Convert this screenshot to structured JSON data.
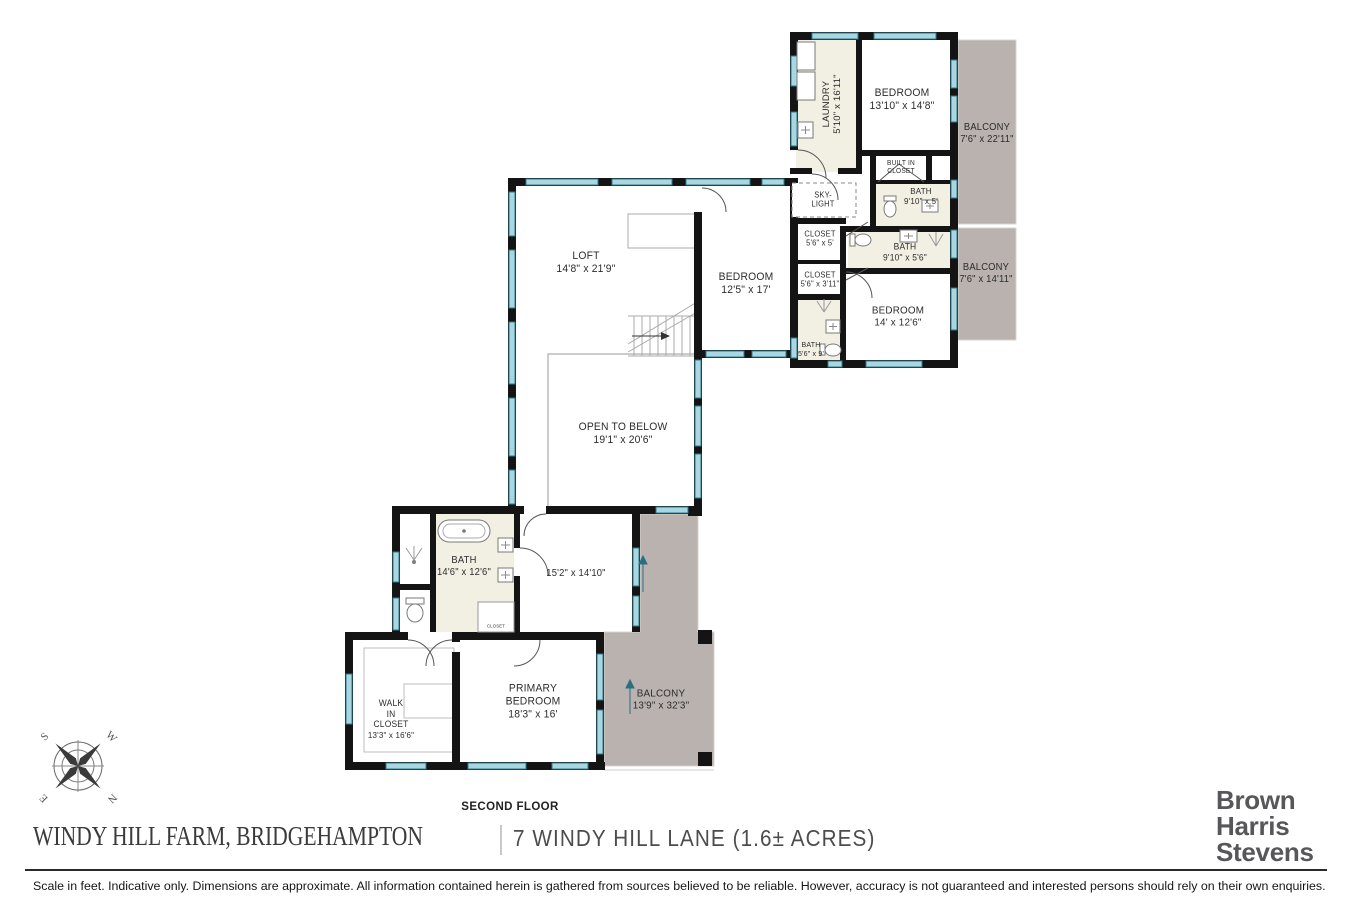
{
  "colors": {
    "wall": "#141414",
    "window_fill": "#a9d6e0",
    "window_border": "#2e7a8b",
    "balcony_fill": "#b9b2ae",
    "bath_floor": "#f2efe3",
    "thin_line": "#bcbcbc",
    "brand_gray": "#57575a"
  },
  "rooms": {
    "laundry": {
      "name": "LAUNDRY",
      "dims": "5'10\" x 16'11\""
    },
    "bedroom_top": {
      "name": "BEDROOM",
      "dims": "13'10\" x 14'8\""
    },
    "balcony_top": {
      "name": "BALCONY",
      "dims": "7'6\" x 22'11\""
    },
    "built_in_closet": {
      "line1": "BUILT IN",
      "line2": "CLOSET"
    },
    "bath_top": {
      "name": "BATH",
      "dims": "9'10\" x 5'"
    },
    "bath_mid": {
      "name": "BATH",
      "dims": "9'10\" x 5'6\""
    },
    "balcony_mid": {
      "name": "BALCONY",
      "dims": "7'6\" x 14'11\""
    },
    "skylight": {
      "line1": "SKY-",
      "line2": "LIGHT"
    },
    "closet_a": {
      "name": "CLOSET",
      "dims": "5'6\" x 5'"
    },
    "closet_b": {
      "name": "CLOSET",
      "dims": "5'6\" x 3'11\""
    },
    "bedroom_mid": {
      "name": "BEDROOM",
      "dims": "14' x 12'6\""
    },
    "bath_small": {
      "name": "BATH",
      "dims": "5'6\" x 9'"
    },
    "loft": {
      "name": "LOFT",
      "dims": "14'8\" x 21'9\""
    },
    "bedroom_left": {
      "name": "BEDROOM",
      "dims": "12'5\" x 17'"
    },
    "open_below": {
      "name": "OPEN TO BELOW",
      "dims": "19'1\" x 20'6\""
    },
    "bath_primary": {
      "name": "BATH",
      "dims": "14'6\" x 12'6\""
    },
    "sitting": {
      "dims": "15'2\" x 14'10\""
    },
    "closet_tiny": {
      "name": "CLOSET"
    },
    "walk_in_closet": {
      "line1": "WALK",
      "line2": "IN",
      "line3": "CLOSET",
      "dims": "13'3\" x 16'6\""
    },
    "primary_bedroom": {
      "line1": "PRIMARY",
      "line2": "BEDROOM",
      "dims": "18'3\" x 16'"
    },
    "balcony_bottom": {
      "name": "BALCONY",
      "dims": "13'9\" x 32'3\""
    }
  },
  "compass": {
    "letters": [
      "S",
      "W",
      "N",
      "E"
    ]
  },
  "footer": {
    "floor_label": "SECOND FLOOR",
    "title_left": "WINDY HILL FARM, BRIDGEHAMPTON",
    "title_right": "7 WINDY HILL LANE (1.6± ACRES)",
    "brand": [
      "Brown",
      "Harris",
      "Stevens"
    ],
    "disclaimer": "Scale in feet. Indicative only. Dimensions are approximate. All information contained herein is gathered from sources believed to be reliable. However, accuracy is not guaranteed and interested persons should rely on their own enquiries."
  }
}
